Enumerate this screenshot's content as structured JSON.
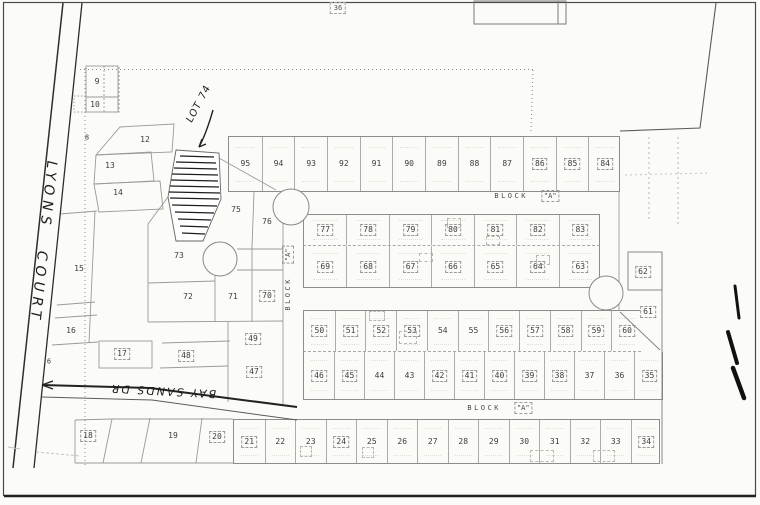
{
  "document_title": "Subdivision plat map (scanned)",
  "streets": {
    "lyons_court": "LYONS COURT",
    "bay_sands": "BAY SANDS DR"
  },
  "labels": {
    "block": "BLOCK",
    "block_letter": "\"A\""
  },
  "annotations": {
    "lot74_note": "LOT 74",
    "sheet_number": "36"
  },
  "colors": {
    "paper": "#fbfbf8",
    "ink": "#3c3c3c",
    "pen": "#1a1a1a",
    "line": "#8d8d8d"
  },
  "blocks": [
    {
      "id": "row-top",
      "cls": "",
      "x0": 228,
      "x1": 620,
      "y0": 136,
      "y1": 192,
      "lots": [
        {
          "n": "95"
        },
        {
          "n": "94"
        },
        {
          "n": "93"
        },
        {
          "n": "92"
        },
        {
          "n": "91"
        },
        {
          "n": "90"
        },
        {
          "n": "89"
        },
        {
          "n": "88"
        },
        {
          "n": "87"
        },
        {
          "n": "86",
          "b": 1
        },
        {
          "n": "85",
          "b": 1
        },
        {
          "n": "84",
          "b": 1
        }
      ]
    },
    {
      "id": "b-upper",
      "cls": "dash-bottom",
      "x0": 303,
      "x1": 600,
      "y0": 214,
      "y1": 246,
      "lots": [
        {
          "n": "77",
          "b": 1
        },
        {
          "n": "78",
          "b": 1
        },
        {
          "n": "79",
          "b": 1
        },
        {
          "n": "80",
          "b": 1
        },
        {
          "n": "81",
          "b": 1
        },
        {
          "n": "82",
          "b": 1
        },
        {
          "n": "83",
          "b": 1
        }
      ]
    },
    {
      "id": "b-lower",
      "cls": "no-top",
      "x0": 303,
      "x1": 600,
      "y0": 246,
      "y1": 288,
      "lots": [
        {
          "n": "69",
          "b": 1
        },
        {
          "n": "68",
          "b": 1
        },
        {
          "n": "67",
          "b": 1
        },
        {
          "n": "66",
          "b": 1
        },
        {
          "n": "65",
          "b": 1
        },
        {
          "n": "64",
          "b": 1
        },
        {
          "n": "63",
          "b": 1
        }
      ]
    },
    {
      "id": "c-upper",
      "cls": "dash-bottom no-right",
      "x0": 303,
      "x1": 641,
      "y0": 310,
      "y1": 352,
      "lots": [
        {
          "n": "50",
          "b": 1
        },
        {
          "n": "51",
          "b": 1
        },
        {
          "n": "52",
          "b": 1
        },
        {
          "n": "53",
          "b": 1
        },
        {
          "n": "54"
        },
        {
          "n": "55"
        },
        {
          "n": "56",
          "b": 1
        },
        {
          "n": "57",
          "b": 1
        },
        {
          "n": "58",
          "b": 1
        },
        {
          "n": "59",
          "b": 1
        },
        {
          "n": "60",
          "b": 1
        }
      ]
    },
    {
      "id": "c-lower",
      "cls": "no-top",
      "x0": 303,
      "x1": 663,
      "y0": 352,
      "y1": 400,
      "lots": [
        {
          "n": "46",
          "b": 1
        },
        {
          "n": "45",
          "b": 1
        },
        {
          "n": "44"
        },
        {
          "n": "43"
        },
        {
          "n": "42",
          "b": 1
        },
        {
          "n": "41",
          "b": 1
        },
        {
          "n": "40",
          "b": 1
        },
        {
          "n": "39",
          "b": 1
        },
        {
          "n": "38",
          "b": 1
        },
        {
          "n": "37"
        },
        {
          "n": "36"
        },
        {
          "n": "35",
          "b": 1
        }
      ]
    },
    {
      "id": "d-row",
      "cls": "",
      "x0": 233,
      "x1": 660,
      "y0": 419,
      "y1": 464,
      "lots": [
        {
          "n": "21",
          "b": 1
        },
        {
          "n": "22"
        },
        {
          "n": "23"
        },
        {
          "n": "24",
          "b": 1
        },
        {
          "n": "25"
        },
        {
          "n": "26"
        },
        {
          "n": "27"
        },
        {
          "n": "28"
        },
        {
          "n": "29"
        },
        {
          "n": "30"
        },
        {
          "n": "31"
        },
        {
          "n": "32"
        },
        {
          "n": "33"
        },
        {
          "n": "34",
          "b": 1
        }
      ]
    }
  ],
  "free_lots": [
    {
      "n": "9",
      "x": 97,
      "y": 82
    },
    {
      "n": "10",
      "x": 95,
      "y": 105
    },
    {
      "n": "8",
      "x": 87,
      "y": 138,
      "sm": 1
    },
    {
      "n": "12",
      "x": 145,
      "y": 140
    },
    {
      "n": "13",
      "x": 110,
      "y": 166
    },
    {
      "n": "14",
      "x": 118,
      "y": 193
    },
    {
      "n": "15",
      "x": 79,
      "y": 269
    },
    {
      "n": "16",
      "x": 71,
      "y": 331
    },
    {
      "n": "17",
      "x": 122,
      "y": 354,
      "b": 1
    },
    {
      "n": "6",
      "x": 49,
      "y": 362,
      "sm": 1
    },
    {
      "n": "18",
      "x": 88,
      "y": 436,
      "b": 1
    },
    {
      "n": "19",
      "x": 173,
      "y": 436
    },
    {
      "n": "20",
      "x": 217,
      "y": 437,
      "b": 1
    },
    {
      "n": "73",
      "x": 179,
      "y": 256
    },
    {
      "n": "72",
      "x": 188,
      "y": 297
    },
    {
      "n": "71",
      "x": 233,
      "y": 297
    },
    {
      "n": "70",
      "x": 267,
      "y": 296,
      "b": 1
    },
    {
      "n": "75",
      "x": 236,
      "y": 210
    },
    {
      "n": "76",
      "x": 267,
      "y": 222
    },
    {
      "n": "74",
      "x": 194,
      "y": 198,
      "sm": 1
    },
    {
      "n": "49",
      "x": 253,
      "y": 339,
      "b": 1
    },
    {
      "n": "48",
      "x": 186,
      "y": 356,
      "b": 1
    },
    {
      "n": "47",
      "x": 254,
      "y": 372,
      "b": 1
    },
    {
      "n": "62",
      "x": 643,
      "y": 272,
      "b": 1
    },
    {
      "n": "61",
      "x": 648,
      "y": 312,
      "b": 1
    }
  ],
  "footprints": [
    [
      300,
      446,
      12,
      11
    ],
    [
      362,
      447,
      12,
      11
    ],
    [
      369,
      311,
      16,
      10
    ],
    [
      399,
      331,
      18,
      13
    ],
    [
      447,
      218,
      14,
      10
    ],
    [
      536,
      255,
      14,
      10
    ],
    [
      530,
      450,
      24,
      12
    ],
    [
      593,
      450,
      22,
      12
    ],
    [
      486,
      236,
      14,
      9
    ],
    [
      419,
      253,
      14,
      9
    ]
  ]
}
